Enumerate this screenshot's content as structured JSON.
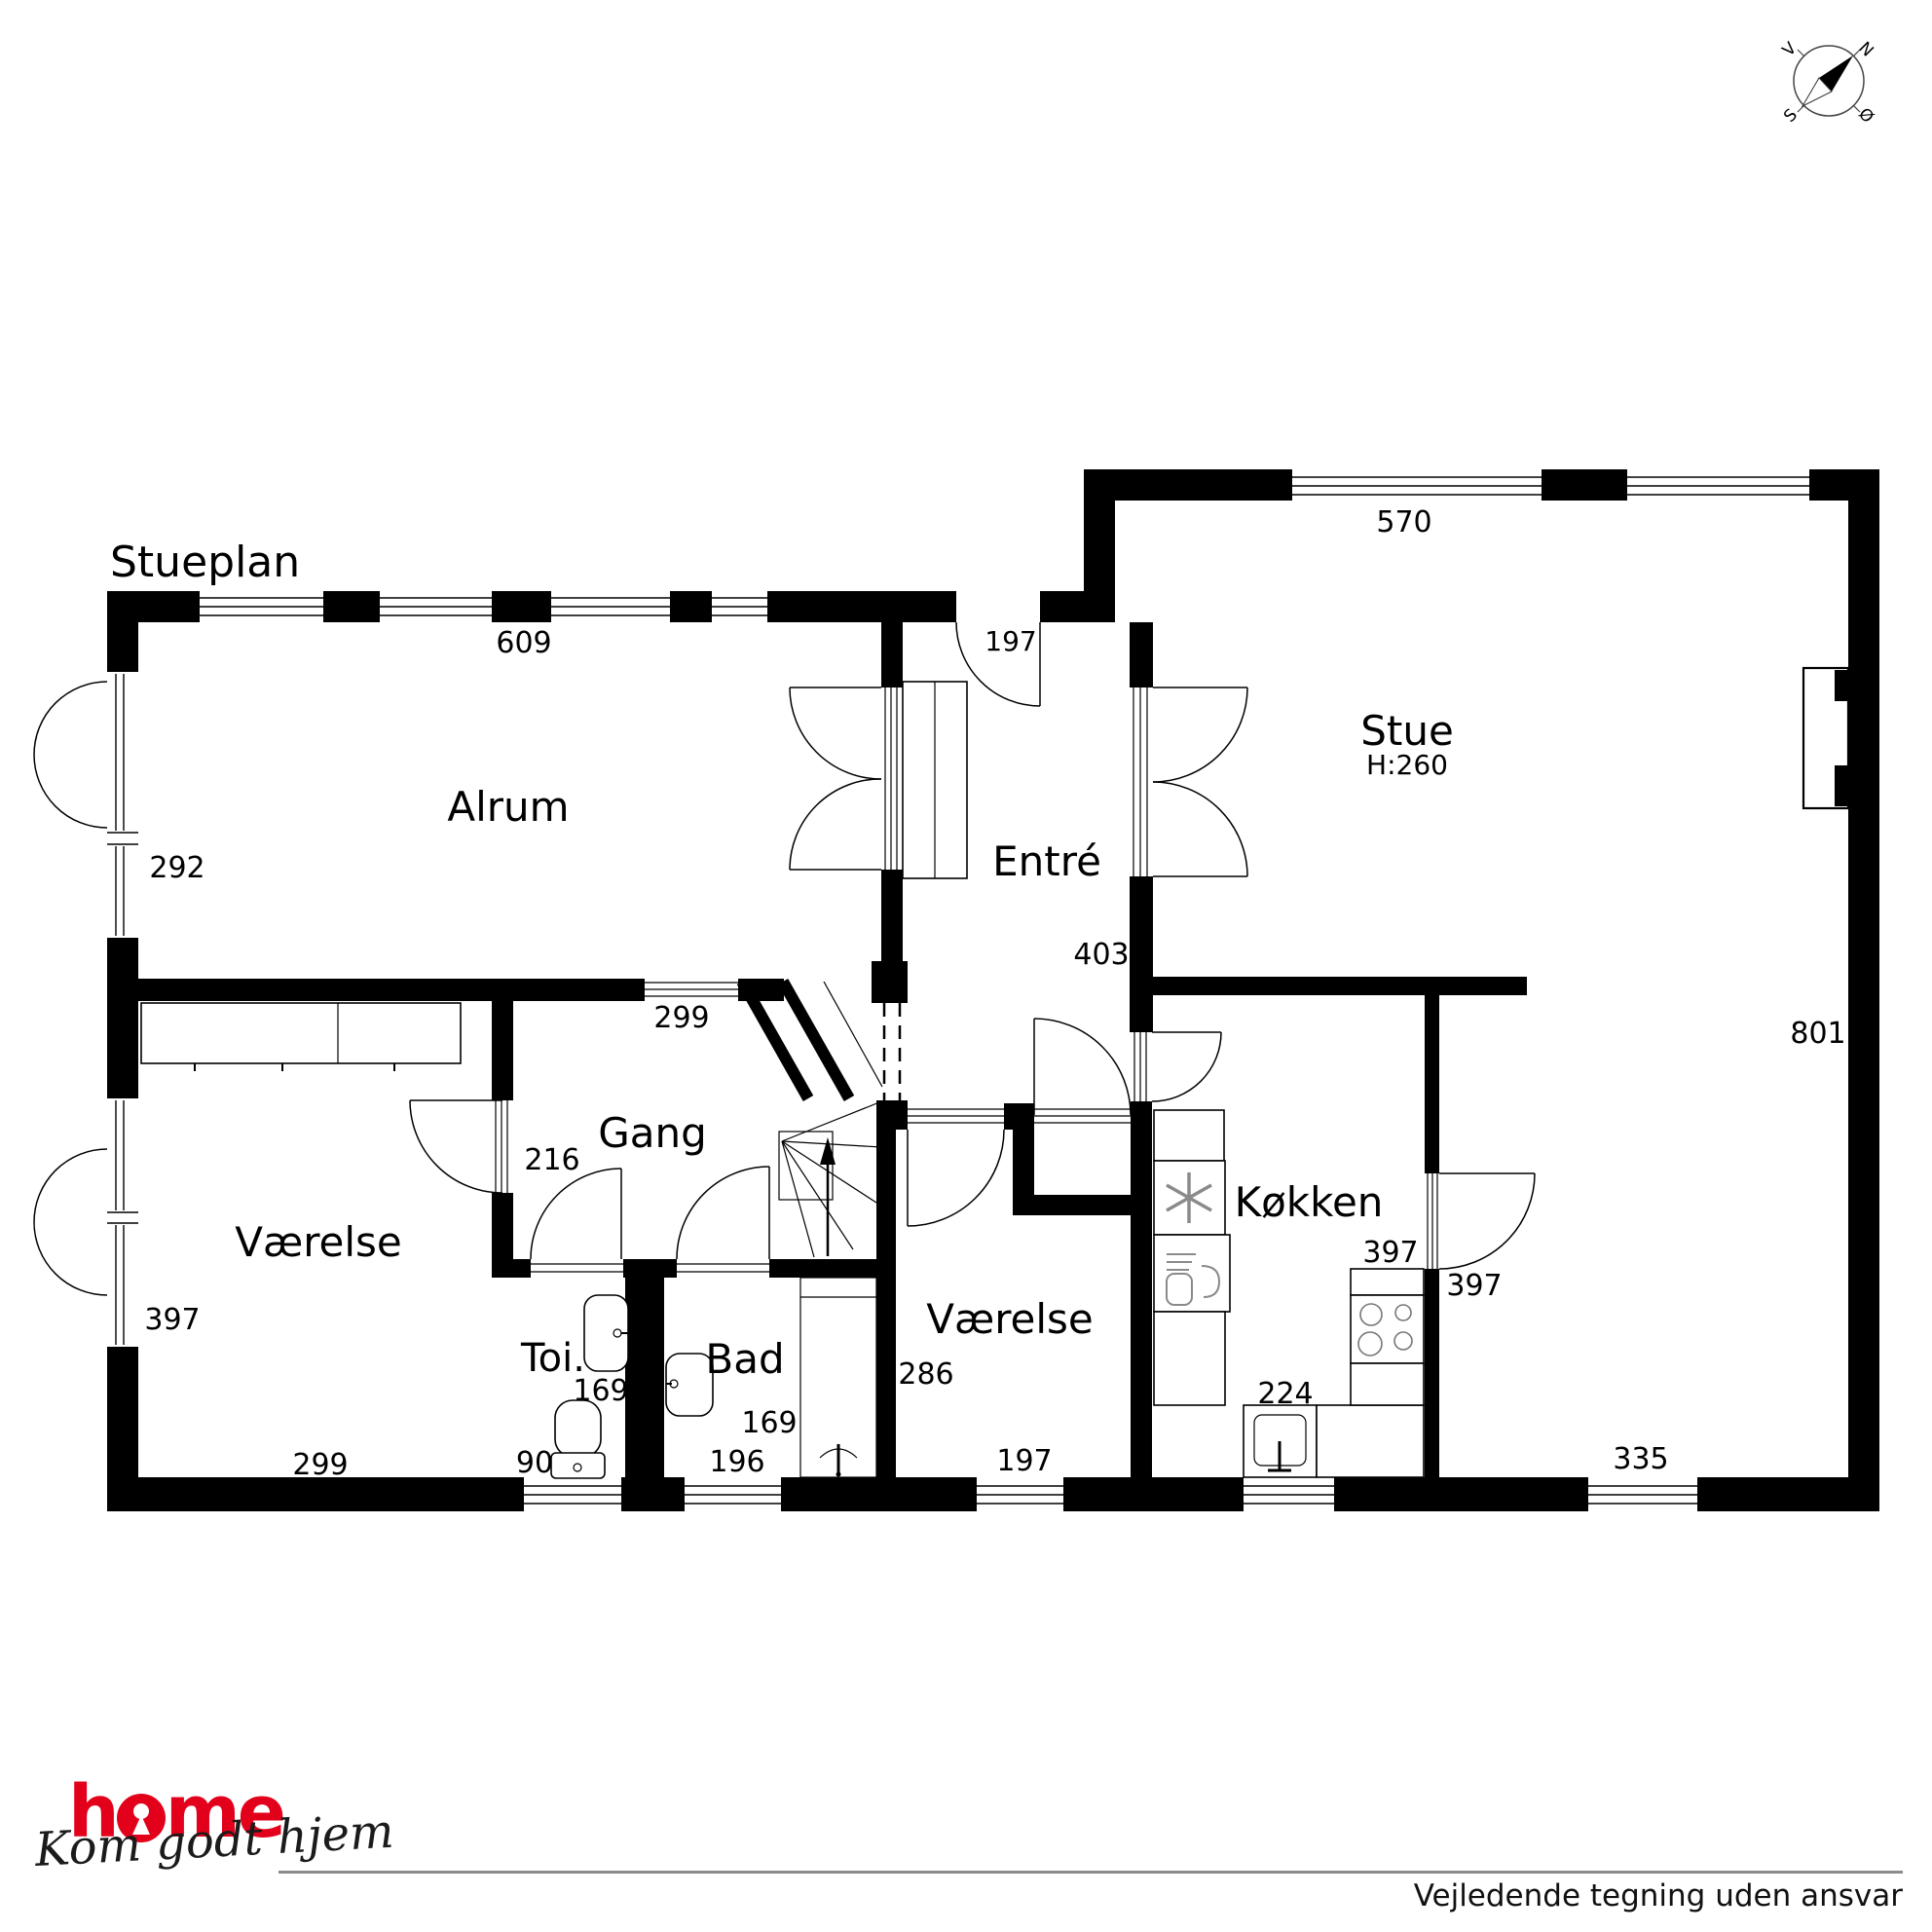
{
  "plan": {
    "title": "Stueplan"
  },
  "rooms": {
    "alrum": "Alrum",
    "entre": "Entré",
    "stue": "Stue",
    "stue_height": "H:260",
    "gang": "Gang",
    "vaerelse_left": "Værelse",
    "vaerelse_mid": "Værelse",
    "toi": "Toi.",
    "bad": "Bad",
    "koekken": "Køkken"
  },
  "dims": {
    "alrum_top_width": "609",
    "front_door": "197",
    "stue_top_width": "570",
    "alrum_left": "292",
    "entre_width": "403",
    "stue_right_height": "801",
    "gang_opening": "299",
    "gang_width": "216",
    "vaerelse_left_width": "397",
    "vaerelse_left_bottom": "299",
    "toi_depth": "169",
    "toi_width": "90",
    "bad_depth": "169",
    "bad_width": "196",
    "vaerelse_mid_depth": "286",
    "vaerelse_mid_width": "197",
    "koekken_door": "397",
    "dining_width": "397",
    "koekken_counter": "224",
    "stue_bottom_window": "335"
  },
  "compass": {
    "north": "N",
    "south": "S",
    "east": "Ø",
    "west": "V"
  },
  "footer": {
    "brand": "home",
    "brand_h": "h",
    "brand_me": "me",
    "slogan": "Kom godt hjem",
    "disclaimer": "Vejledende tegning uden ansvar"
  },
  "colors": {
    "brand_red": "#e2001a",
    "wall": "#000000",
    "rule_gray": "#8c8c8c",
    "icon_gray": "#8a8a8a"
  }
}
